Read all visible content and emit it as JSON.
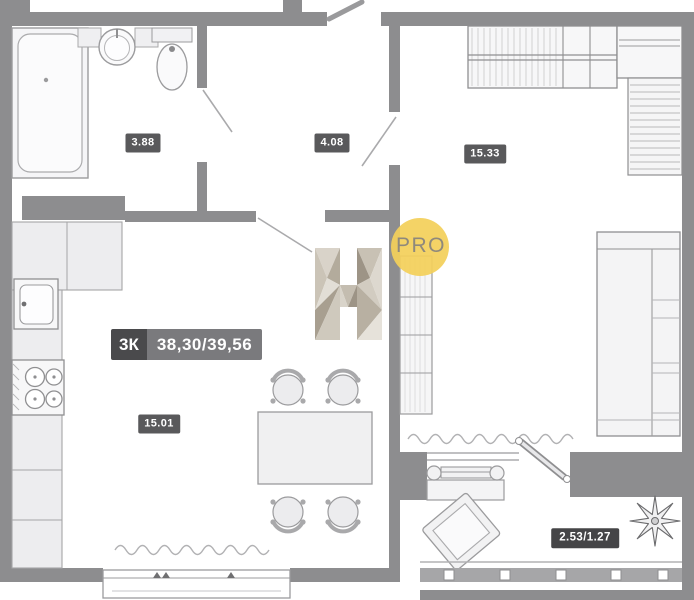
{
  "floor_plan": {
    "summary": {
      "rooms_count": "3К",
      "total_area": "38,30/39,56"
    },
    "room_areas": {
      "bathroom": "3.88",
      "hallway": "4.08",
      "bedroom": "15.33",
      "kitchen_living": "15.01",
      "balcony": "2.53/1.27"
    },
    "watermark": {
      "letter": "H",
      "badge": "PRO"
    },
    "colors": {
      "wall": "#8d8d8f",
      "area_badge_bg": "#59595b",
      "balcony_badge_bg": "#454547",
      "summary_rooms_bg": "#4a4a4c",
      "summary_area_bg": "#7a7a7d",
      "watermark_circle": "#f3d05a",
      "watermark_text": "#8f897c"
    }
  }
}
